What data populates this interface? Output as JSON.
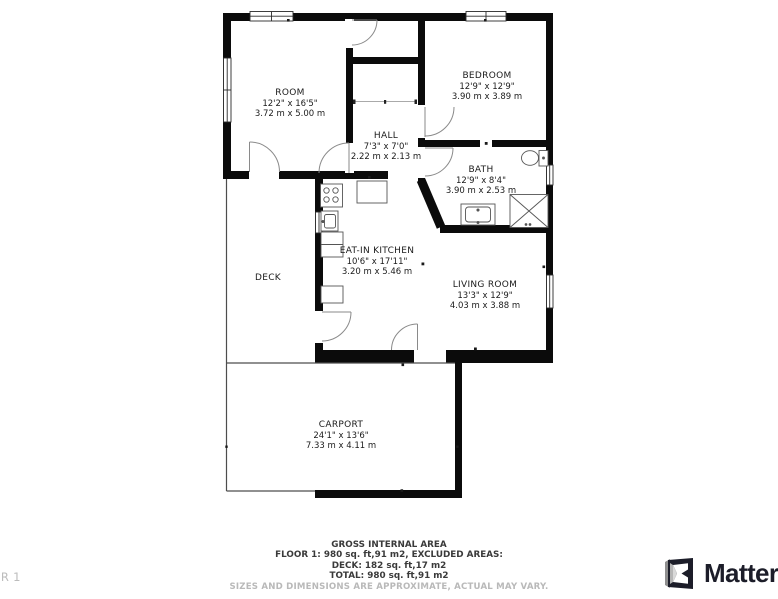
{
  "floorplan": {
    "floor_indicator": "FLOOR 1",
    "rooms": [
      {
        "name": "ROOM",
        "dims_ft": "12'2\" x 16'5\"",
        "dims_m": "3.72 m x 5.00 m"
      },
      {
        "name": "BEDROOM",
        "dims_ft": "12'9\" x 12'9\"",
        "dims_m": "3.90 m x 3.89 m"
      },
      {
        "name": "HALL",
        "dims_ft": "7'3\" x 7'0\"",
        "dims_m": "2.22 m x 2.13 m"
      },
      {
        "name": "BATH",
        "dims_ft": "12'9\" x 8'4\"",
        "dims_m": "3.90 m x 2.53 m"
      },
      {
        "name": "EAT-IN KITCHEN",
        "dims_ft": "10'6\" x 17'11\"",
        "dims_m": "3.20 m x 5.46 m"
      },
      {
        "name": "LIVING ROOM",
        "dims_ft": "13'3\" x 12'9\"",
        "dims_m": "4.03 m x 3.88 m"
      },
      {
        "name": "DECK",
        "dims_ft": "",
        "dims_m": ""
      },
      {
        "name": "CARPORT",
        "dims_ft": "24'1\" x 13'6\"",
        "dims_m": "7.33 m x 4.11 m"
      }
    ]
  },
  "footer": {
    "title": "GROSS INTERNAL AREA",
    "line1": "FLOOR 1: 980 sq. ft,91 m2, EXCLUDED AREAS:",
    "line2": "DECK: 182 sq. ft,17 m2",
    "line3": "TOTAL: 980 sq. ft,91 m2",
    "disclaimer": "SIZES AND DIMENSIONS ARE APPROXIMATE, ACTUAL MAY VARY."
  },
  "branding": {
    "logo_text": "Matterport"
  },
  "colors": {
    "wall": "#0b0b0b",
    "label_text": "#1b1b1b",
    "thin_outline": "#4d4d4d",
    "door_arc": "#777777",
    "disclaimer_text": "#b9b9b9",
    "brand_dark": "#1c1d29"
  }
}
